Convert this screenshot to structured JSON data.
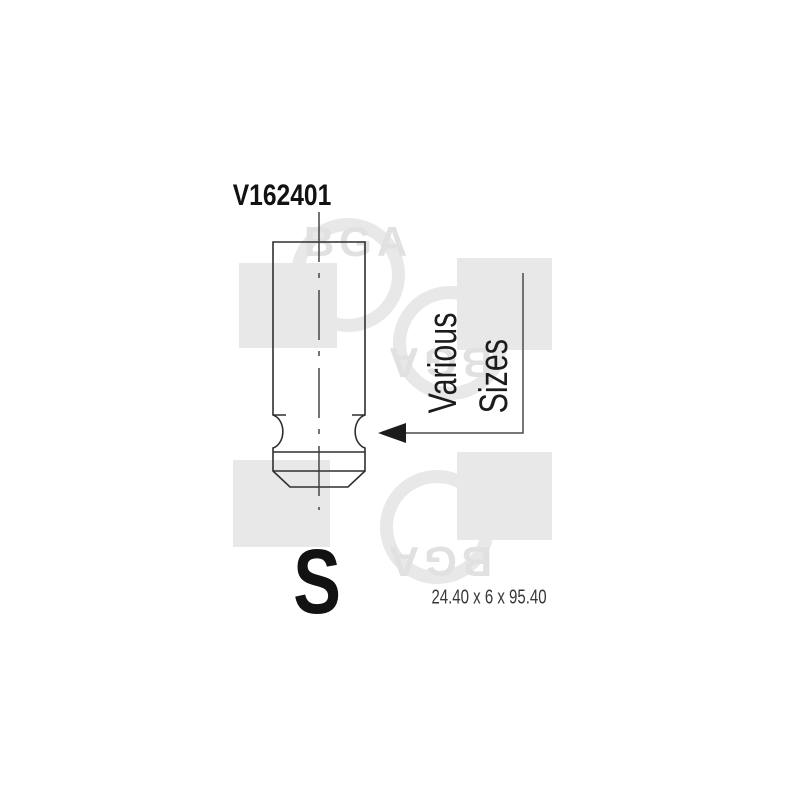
{
  "product_image": {
    "part_number": "V162401",
    "size_label": {
      "line1": "Various",
      "line2": "Sizes"
    },
    "variant_letter": "S",
    "dimensions": "24.40 x 6 x 95.40",
    "watermark_brand": "BGA",
    "colors": {
      "background": "#ffffff",
      "drawing_line": "#2f2f2f",
      "text": "#121212",
      "watermark_fill": "#e7e8e7",
      "watermark_text": "#e0e1e0"
    }
  }
}
